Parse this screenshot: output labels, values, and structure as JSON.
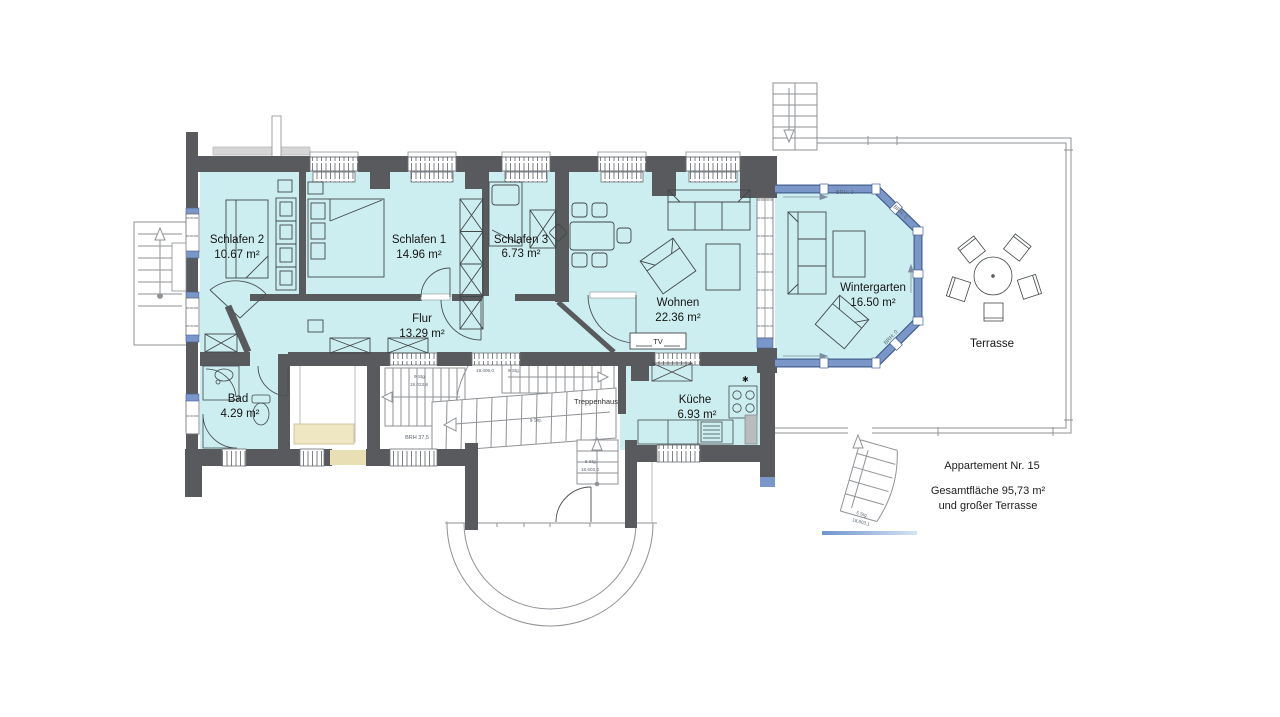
{
  "plan": {
    "title": "Appartement Nr. 15 Grundriss",
    "rooms": [
      {
        "name": "Schlafen 2",
        "area": "10.67 m²"
      },
      {
        "name": "Schlafen 1",
        "area": "14.96 m²"
      },
      {
        "name": "Schlafen 3",
        "area": "6.73 m²"
      },
      {
        "name": "Wohnen",
        "area": "22.36 m²"
      },
      {
        "name": "Flur",
        "area": "13.29 m²"
      },
      {
        "name": "Bad",
        "area": "4.29 m²"
      },
      {
        "name": "Küche",
        "area": "6.93 m²"
      },
      {
        "name": "Wintergarten",
        "area": "16.50 m²"
      },
      {
        "name": "Terrasse",
        "area": ""
      }
    ],
    "labels": {
      "treppenhaus": "Treppenhaus",
      "tv": "TV",
      "brh375": "BRH 37,5",
      "brh0": "BRH: 0",
      "stg9": "9 Stg.",
      "stg5": "5 Stg.",
      "dim19406": "19.406,0",
      "dim19023": "19.023,8",
      "dim18603_4": "18.603,4",
      "dim18603_1": "18.603,1"
    },
    "legend": {
      "line1": "Appartement Nr. 15",
      "line2": "Gesamtfläche 95,73 m²",
      "line3": "und großer Terrasse"
    },
    "colors": {
      "wall": "#595a5e",
      "room_fill": "#cdeef0",
      "window_blue": "#7b97c9",
      "window_blue_dark": "#45618f",
      "wood": "#e9dfb4"
    }
  }
}
